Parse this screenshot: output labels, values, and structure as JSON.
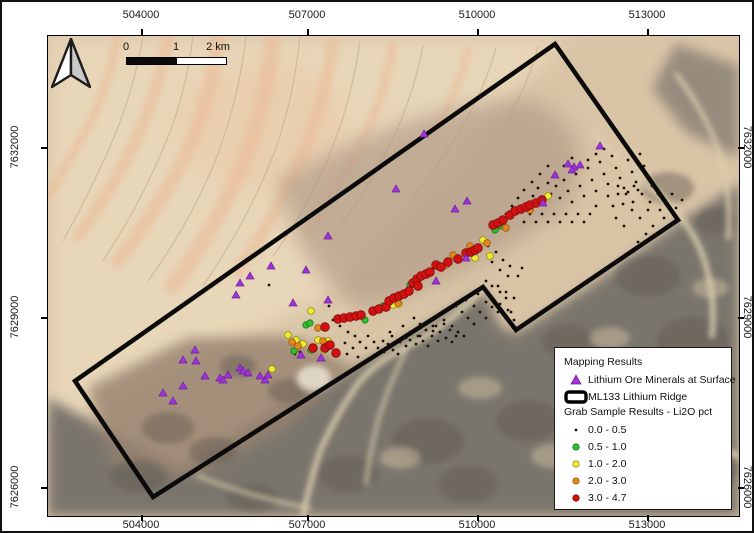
{
  "scalebar": {
    "labels": [
      "0",
      "1",
      "2 km"
    ]
  },
  "axes": {
    "top": [
      {
        "text": "504000",
        "x": 139
      },
      {
        "text": "507000",
        "x": 305
      },
      {
        "text": "510000",
        "x": 475
      },
      {
        "text": "513000",
        "x": 645
      }
    ],
    "bottom": [
      {
        "text": "504000",
        "x": 139
      },
      {
        "text": "507000",
        "x": 305
      },
      {
        "text": "510000",
        "x": 475
      },
      {
        "text": "513000",
        "x": 645
      }
    ],
    "left": [
      {
        "text": "7632000",
        "y": 145
      },
      {
        "text": "7629000",
        "y": 315
      },
      {
        "text": "7626000",
        "y": 485
      }
    ],
    "right": [
      {
        "text": "7632000",
        "y": 145
      },
      {
        "text": "7629000",
        "y": 315
      },
      {
        "text": "7626000",
        "y": 485
      }
    ]
  },
  "legend": {
    "title_mapping": "Mapping Results",
    "title_grab": "Grab Sample Results - Li2O pct",
    "mapping_items": [
      {
        "label": "Lithium Ore Minerals at Surface",
        "symbol": "triangle",
        "color": "#a133d6",
        "stroke": "#6b1fa0"
      },
      {
        "label": "ML133 Lithium Ridge",
        "symbol": "boundary-rect",
        "color": "#000000"
      }
    ],
    "grab_classes": [
      {
        "key": "c00_05",
        "label": "0.0 - 0.5",
        "color": "#1a1208",
        "stroke": "none",
        "legend_r": 1.4,
        "map_r": 1.4
      },
      {
        "key": "c05_10",
        "label": "0.5 - 1.0",
        "color": "#2fbe2f",
        "stroke": "#157a15",
        "legend_r": 3.2,
        "map_r": 3.2
      },
      {
        "key": "c10_20",
        "label": "1.0 - 2.0",
        "color": "#f2ea2e",
        "stroke": "#8f8f12",
        "legend_r": 3.2,
        "map_r": 3.4
      },
      {
        "key": "c20_30",
        "label": "2.0 - 3.0",
        "color": "#e0861f",
        "stroke": "#9a5a10",
        "legend_r": 3.2,
        "map_r": 3.4
      },
      {
        "key": "c30_47",
        "label": "3.0 - 4.7",
        "color": "#d41111",
        "stroke": "#7c0b0b",
        "legend_r": 3.2,
        "map_r": 4.3
      }
    ]
  },
  "map": {
    "boundary_polygon": [
      [
        507,
        8
      ],
      [
        630,
        184
      ],
      [
        468,
        294
      ],
      [
        435,
        251
      ],
      [
        105,
        461
      ],
      [
        27,
        345
      ]
    ],
    "ore_triangles": [
      [
        115,
        357
      ],
      [
        125,
        365
      ],
      [
        135,
        324
      ],
      [
        135,
        350
      ],
      [
        147,
        314
      ],
      [
        148,
        325
      ],
      [
        157,
        340
      ],
      [
        172,
        342
      ],
      [
        175,
        344
      ],
      [
        180,
        339
      ],
      [
        192,
        332
      ],
      [
        195,
        335
      ],
      [
        200,
        337
      ],
      [
        212,
        340
      ],
      [
        217,
        344
      ],
      [
        220,
        339
      ],
      [
        188,
        259
      ],
      [
        192,
        247
      ],
      [
        202,
        240
      ],
      [
        223,
        230
      ],
      [
        245,
        267
      ],
      [
        258,
        234
      ],
      [
        280,
        200
      ],
      [
        253,
        319
      ],
      [
        273,
        322
      ],
      [
        388,
        245
      ],
      [
        418,
        222
      ],
      [
        376,
        98
      ],
      [
        348,
        153
      ],
      [
        407,
        173
      ],
      [
        419,
        165
      ],
      [
        495,
        167
      ],
      [
        507,
        139
      ],
      [
        520,
        128
      ],
      [
        526,
        131
      ],
      [
        532,
        129
      ],
      [
        524,
        134
      ],
      [
        552,
        110
      ],
      [
        280,
        264
      ]
    ],
    "samples": {
      "c00_05": [
        [
          285,
          284
        ],
        [
          292,
          290
        ],
        [
          300,
          296
        ],
        [
          307,
          300
        ],
        [
          297,
          307
        ],
        [
          305,
          312
        ],
        [
          312,
          306
        ],
        [
          318,
          312
        ],
        [
          320,
          300
        ],
        [
          326,
          306
        ],
        [
          330,
          312
        ],
        [
          336,
          316
        ],
        [
          340,
          308
        ],
        [
          345,
          314
        ],
        [
          350,
          318
        ],
        [
          344,
          300
        ],
        [
          352,
          306
        ],
        [
          358,
          310
        ],
        [
          362,
          304
        ],
        [
          368,
          308
        ],
        [
          355,
          290
        ],
        [
          362,
          296
        ],
        [
          370,
          300
        ],
        [
          375,
          305
        ],
        [
          380,
          310
        ],
        [
          366,
          282
        ],
        [
          372,
          288
        ],
        [
          378,
          294
        ],
        [
          384,
          300
        ],
        [
          390,
          305
        ],
        [
          385,
          290
        ],
        [
          392,
          296
        ],
        [
          398,
          302
        ],
        [
          404,
          306
        ],
        [
          396,
          288
        ],
        [
          402,
          294
        ],
        [
          408,
          300
        ],
        [
          389,
          280
        ],
        [
          396,
          284
        ],
        [
          404,
          290
        ],
        [
          410,
          296
        ],
        [
          416,
          300
        ],
        [
          408,
          270
        ],
        [
          414,
          276
        ],
        [
          420,
          282
        ],
        [
          426,
          288
        ],
        [
          418,
          264
        ],
        [
          426,
          270
        ],
        [
          432,
          276
        ],
        [
          438,
          282
        ],
        [
          430,
          258
        ],
        [
          438,
          266
        ],
        [
          444,
          271
        ],
        [
          450,
          276
        ],
        [
          444,
          250
        ],
        [
          452,
          256
        ],
        [
          458,
          262
        ],
        [
          299,
          318
        ],
        [
          310,
          321
        ],
        [
          281,
          270
        ],
        [
          221,
          249
        ],
        [
          247,
          318
        ],
        [
          252,
          316
        ],
        [
          335,
          305
        ],
        [
          346,
          308
        ],
        [
          358,
          302
        ],
        [
          342,
          296
        ],
        [
          372,
          300
        ],
        [
          385,
          295
        ],
        [
          388,
          290
        ],
        [
          485,
          160
        ],
        [
          490,
          152
        ],
        [
          495,
          165
        ],
        [
          500,
          147
        ],
        [
          503,
          158
        ],
        [
          508,
          150
        ],
        [
          512,
          162
        ],
        [
          516,
          144
        ],
        [
          520,
          155
        ],
        [
          524,
          166
        ],
        [
          528,
          138
        ],
        [
          532,
          150
        ],
        [
          536,
          160
        ],
        [
          540,
          132
        ],
        [
          544,
          144
        ],
        [
          548,
          155
        ],
        [
          552,
          126
        ],
        [
          556,
          138
        ],
        [
          560,
          148
        ],
        [
          564,
          120
        ],
        [
          568,
          132
        ],
        [
          572,
          142
        ],
        [
          576,
          152
        ],
        [
          580,
          124
        ],
        [
          584,
          136
        ],
        [
          588,
          146
        ],
        [
          592,
          118
        ],
        [
          596,
          130
        ],
        [
          600,
          140
        ],
        [
          604,
          150
        ],
        [
          560,
          160
        ],
        [
          565,
          170
        ],
        [
          570,
          158
        ],
        [
          575,
          168
        ],
        [
          580,
          156
        ],
        [
          585,
          166
        ],
        [
          590,
          154
        ],
        [
          548,
          170
        ],
        [
          542,
          178
        ],
        [
          536,
          186
        ],
        [
          530,
          178
        ],
        [
          524,
          186
        ],
        [
          518,
          178
        ],
        [
          512,
          186
        ],
        [
          506,
          178
        ],
        [
          500,
          186
        ],
        [
          494,
          178
        ],
        [
          488,
          186
        ],
        [
          482,
          178
        ],
        [
          476,
          186
        ],
        [
          610,
          158
        ],
        [
          600,
          174
        ],
        [
          592,
          182
        ],
        [
          584,
          174
        ],
        [
          576,
          190
        ],
        [
          568,
          182
        ],
        [
          605,
          190
        ],
        [
          598,
          198
        ],
        [
          590,
          206
        ],
        [
          570,
          150
        ],
        [
          578,
          158
        ],
        [
          586,
          150
        ],
        [
          594,
          158
        ],
        [
          602,
          166
        ],
        [
          612,
          174
        ],
        [
          618,
          166
        ],
        [
          624,
          158
        ],
        [
          616,
          182
        ],
        [
          608,
          198
        ],
        [
          556,
          113
        ],
        [
          548,
          118
        ],
        [
          540,
          124
        ],
        [
          532,
          130
        ],
        [
          524,
          122
        ],
        [
          516,
          130
        ],
        [
          508,
          138
        ],
        [
          500,
          130
        ],
        [
          492,
          138
        ],
        [
          484,
          146
        ],
        [
          476,
          154
        ],
        [
          470,
          162
        ],
        [
          464,
          170
        ],
        [
          458,
          178
        ],
        [
          452,
          186
        ],
        [
          446,
          194
        ],
        [
          628,
          172
        ],
        [
          634,
          164
        ],
        [
          440,
          210
        ],
        [
          448,
          216
        ],
        [
          455,
          224
        ],
        [
          462,
          230
        ],
        [
          444,
          226
        ],
        [
          452,
          234
        ],
        [
          460,
          240
        ],
        [
          450,
          250
        ],
        [
          458,
          256
        ],
        [
          466,
          262
        ],
        [
          444,
          262
        ],
        [
          452,
          268
        ],
        [
          460,
          274
        ],
        [
          438,
          245
        ],
        [
          463,
          276
        ],
        [
          466,
          284
        ],
        [
          470,
          240
        ],
        [
          474,
          232
        ]
      ],
      "c05_10": [
        [
          258,
          289
        ],
        [
          262,
          287
        ],
        [
          246,
          315
        ],
        [
          263,
          314
        ],
        [
          335,
          270
        ],
        [
          362,
          249
        ],
        [
          452,
          190
        ],
        [
          447,
          194
        ],
        [
          317,
          284
        ]
      ],
      "c10_20": [
        [
          224,
          333
        ],
        [
          240,
          299
        ],
        [
          248,
          304
        ],
        [
          255,
          308
        ],
        [
          270,
          304
        ],
        [
          280,
          305
        ],
        [
          263,
          275
        ],
        [
          345,
          269
        ],
        [
          351,
          268
        ],
        [
          408,
          222
        ],
        [
          427,
          222
        ],
        [
          435,
          204
        ],
        [
          442,
          220
        ],
        [
          500,
          160
        ],
        [
          276,
          314
        ]
      ],
      "c20_30": [
        [
          244,
          306
        ],
        [
          250,
          310
        ],
        [
          270,
          292
        ],
        [
          275,
          305
        ],
        [
          350,
          267
        ],
        [
          405,
          219
        ],
        [
          422,
          210
        ],
        [
          458,
          192
        ],
        [
          439,
          207
        ],
        [
          398,
          229
        ],
        [
          482,
          174
        ]
      ],
      "c30_47": [
        [
          277,
          291
        ],
        [
          277,
          312
        ],
        [
          282,
          309
        ],
        [
          288,
          317
        ],
        [
          290,
          283
        ],
        [
          296,
          282
        ],
        [
          302,
          281
        ],
        [
          308,
          280
        ],
        [
          313,
          279
        ],
        [
          325,
          275
        ],
        [
          331,
          273
        ],
        [
          338,
          271
        ],
        [
          341,
          265
        ],
        [
          346,
          262
        ],
        [
          351,
          260
        ],
        [
          356,
          258
        ],
        [
          361,
          255
        ],
        [
          365,
          247
        ],
        [
          369,
          243
        ],
        [
          373,
          240
        ],
        [
          378,
          238
        ],
        [
          382,
          236
        ],
        [
          370,
          250
        ],
        [
          388,
          229
        ],
        [
          393,
          231
        ],
        [
          400,
          226
        ],
        [
          410,
          223
        ],
        [
          418,
          217
        ],
        [
          423,
          216
        ],
        [
          427,
          214
        ],
        [
          430,
          212
        ],
        [
          445,
          189
        ],
        [
          450,
          187
        ],
        [
          455,
          184
        ],
        [
          462,
          179
        ],
        [
          467,
          175
        ],
        [
          473,
          173
        ],
        [
          478,
          171
        ],
        [
          482,
          169
        ],
        [
          488,
          167
        ],
        [
          494,
          164
        ],
        [
          265,
          312
        ]
      ]
    }
  }
}
